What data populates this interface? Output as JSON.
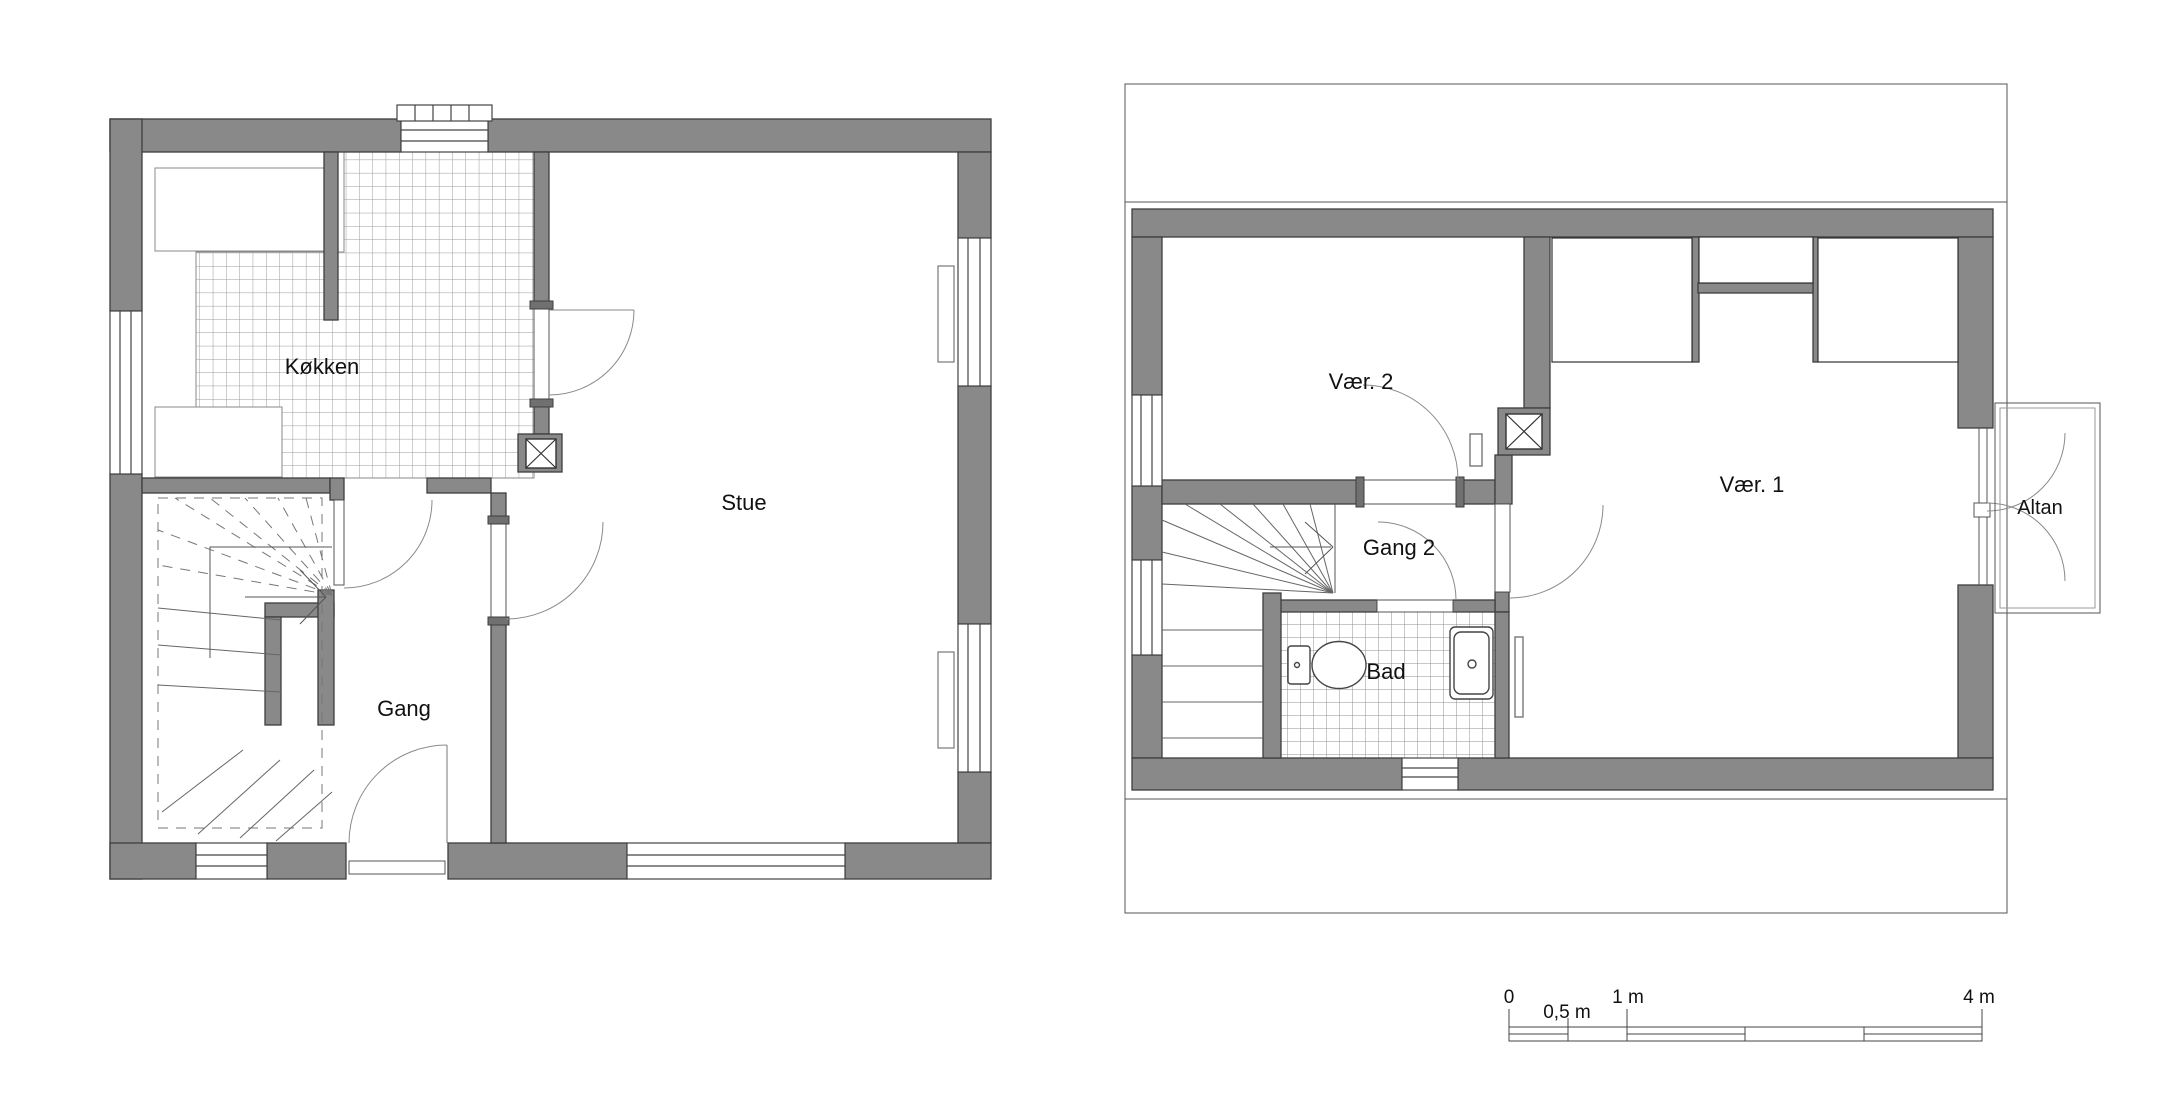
{
  "sheet": {
    "background": "#ffffff",
    "type": "floor-plan-drawing"
  },
  "ground_floor": {
    "rooms": {
      "kitchen": "Køkken",
      "living_room": "Stue",
      "hallway": "Gang"
    }
  },
  "upper_floor": {
    "rooms": {
      "room2": "Vær. 2",
      "room1": "Vær. 1",
      "hallway2": "Gang 2",
      "bathroom": "Bad",
      "balcony": "Altan"
    }
  },
  "scale_bar": {
    "labels": {
      "zero": "0",
      "half": "0,5 m",
      "one": "1 m",
      "four": "4 m"
    }
  },
  "colors": {
    "wall_fill": "#898989",
    "wall_edge": "#3e3e3e",
    "thin_line": "#444444",
    "door_arc": "#8a8a8a",
    "tile_line": "#9a9a9a",
    "dashed_line": "#777777"
  }
}
